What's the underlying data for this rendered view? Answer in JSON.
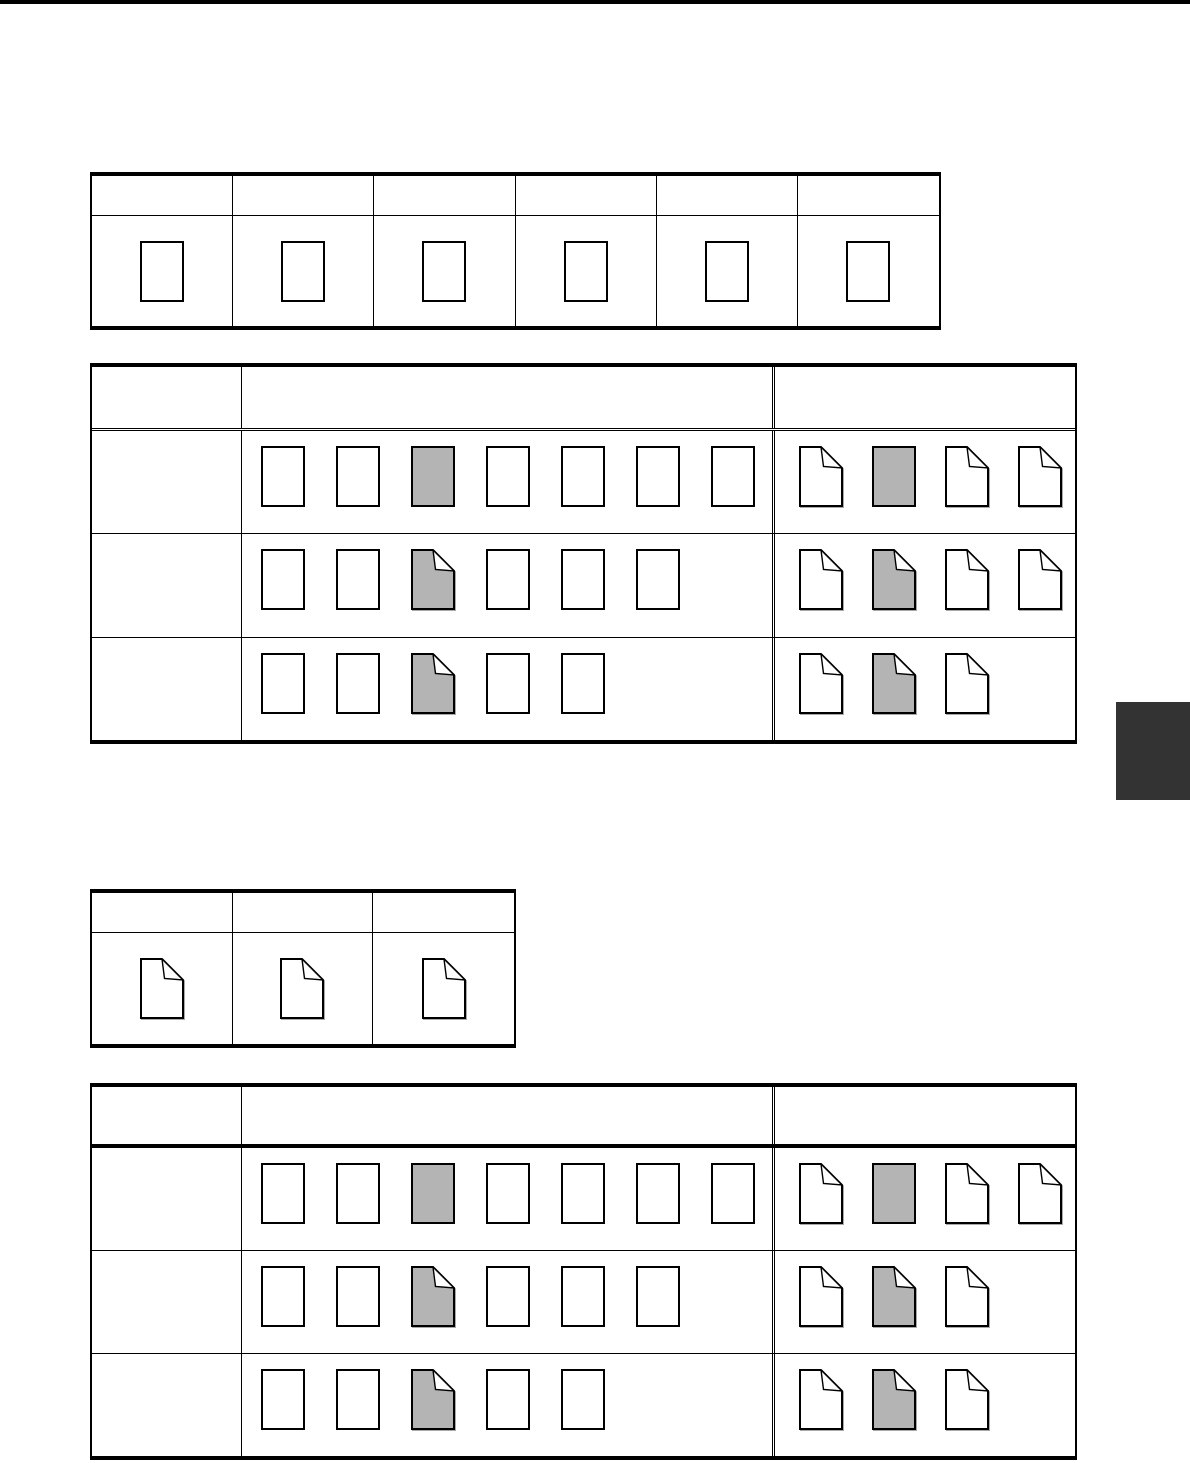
{
  "colors": {
    "page_bg": "#ffffff",
    "rule": "#000000",
    "icon_gray": "#b4b4b4",
    "icon_white": "#ffffff",
    "side_tab_dark": "#333333",
    "top_bar": "#000000"
  },
  "icon_legend": {
    "plain-doc": "plain portrait document sheet",
    "plain-doc-gray": "gray-highlighted document sheet",
    "folded-doc": "document sheet with folded top-right corner",
    "folded-doc-gray": "gray-highlighted sheet with folded corner"
  },
  "tables": [
    {
      "id": "table-1",
      "kind": "simple",
      "columns": 6,
      "header_texts": [
        "",
        "",
        "",
        "",
        "",
        ""
      ],
      "cells": [
        [
          "plain-doc"
        ],
        [
          "plain-doc"
        ],
        [
          "plain-doc"
        ],
        [
          "plain-doc"
        ],
        [
          "plain-doc"
        ],
        [
          "plain-doc"
        ]
      ]
    },
    {
      "id": "table-2",
      "kind": "matrix",
      "header_texts": [
        "",
        "",
        ""
      ],
      "rows": [
        {
          "label": "",
          "left": [
            "plain-doc",
            "plain-doc",
            "plain-doc-gray",
            "plain-doc",
            "plain-doc",
            "plain-doc",
            "plain-doc"
          ],
          "right": [
            "folded-doc",
            "plain-doc-gray",
            "folded-doc",
            "folded-doc"
          ]
        },
        {
          "label": "",
          "left": [
            "plain-doc",
            "plain-doc",
            "folded-doc-gray",
            "plain-doc",
            "plain-doc",
            "plain-doc"
          ],
          "right": [
            "folded-doc",
            "folded-doc-gray",
            "folded-doc",
            "folded-doc"
          ]
        },
        {
          "label": "",
          "left": [
            "plain-doc",
            "plain-doc",
            "folded-doc-gray",
            "plain-doc",
            "plain-doc"
          ],
          "right": [
            "folded-doc",
            "folded-doc-gray",
            "folded-doc"
          ]
        }
      ]
    },
    {
      "id": "table-3",
      "kind": "simple",
      "columns": 3,
      "header_texts": [
        "",
        "",
        ""
      ],
      "cells": [
        [
          "folded-doc"
        ],
        [
          "folded-doc"
        ],
        [
          "folded-doc"
        ]
      ]
    },
    {
      "id": "table-4",
      "kind": "matrix",
      "header_texts": [
        "",
        "",
        ""
      ],
      "rows": [
        {
          "label": "",
          "left": [
            "plain-doc",
            "plain-doc",
            "plain-doc-gray",
            "plain-doc",
            "plain-doc",
            "plain-doc",
            "plain-doc"
          ],
          "right": [
            "folded-doc",
            "plain-doc-gray",
            "folded-doc",
            "folded-doc"
          ]
        },
        {
          "label": "",
          "left": [
            "plain-doc",
            "plain-doc",
            "folded-doc-gray",
            "plain-doc",
            "plain-doc",
            "plain-doc"
          ],
          "right": [
            "folded-doc",
            "folded-doc-gray",
            "folded-doc"
          ]
        },
        {
          "label": "",
          "left": [
            "plain-doc",
            "plain-doc",
            "folded-doc-gray",
            "plain-doc",
            "plain-doc"
          ],
          "right": [
            "folded-doc",
            "folded-doc-gray",
            "folded-doc"
          ]
        }
      ]
    }
  ]
}
